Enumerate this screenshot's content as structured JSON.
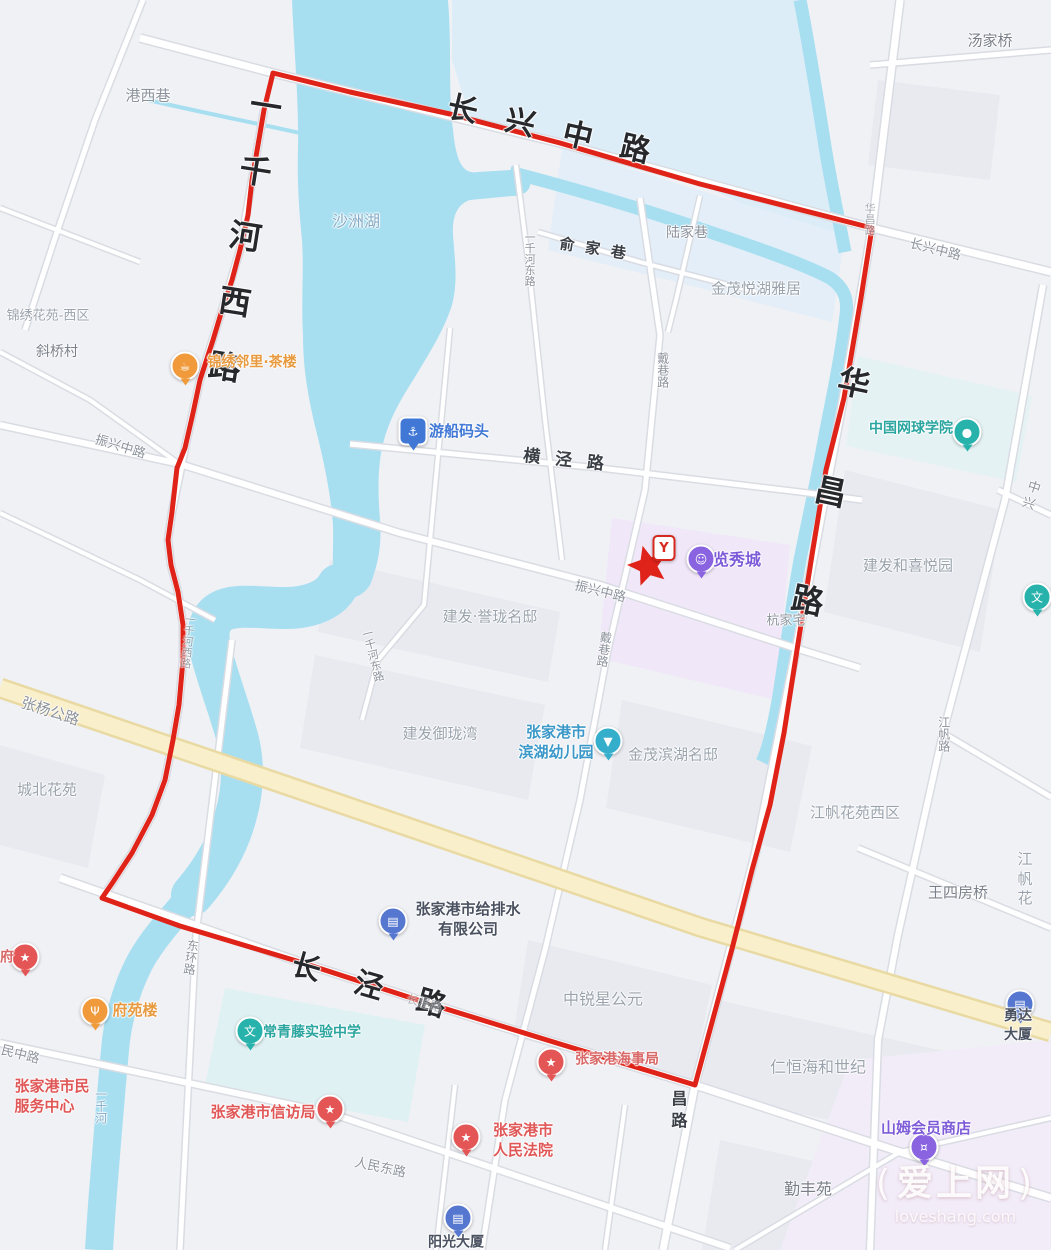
{
  "map": {
    "palette": {
      "road": "#8d939c",
      "town": "#7a8089",
      "area": "#9aa3ad",
      "water": "#85abc6",
      "big": "#26282c",
      "semidark": "#3a3f46",
      "red": "#e05757",
      "maroon": "#d96868",
      "orange": "#e89a40",
      "blue": "#4178d6",
      "purple": "#7d5bd8",
      "teal": "#2ba5a0",
      "kteal": "#3b98c8",
      "slate": "#4a5160"
    },
    "labels": [
      {
        "t": "港西巷",
        "x": 148,
        "y": 96,
        "s": 15,
        "c": "road"
      },
      {
        "t": "汤家桥",
        "x": 990,
        "y": 41,
        "s": 15,
        "c": "town"
      },
      {
        "t": "沙洲湖",
        "x": 356,
        "y": 222,
        "s": 16,
        "c": "water"
      },
      {
        "t": "长兴中路",
        "x": 563,
        "y": 133,
        "s": 30,
        "c": "big",
        "r": 13,
        "ls": 29,
        "w": 700
      },
      {
        "t": "一千河西路",
        "x": 240,
        "y": 252,
        "s": 32,
        "c": "big",
        "v": true,
        "r": 9,
        "ls": 34,
        "w": 700
      },
      {
        "t": "华昌路",
        "x": 820,
        "y": 529,
        "s": 32,
        "c": "big",
        "v": true,
        "r": 12,
        "ls": 79,
        "w": 700
      },
      {
        "t": "长泾路",
        "x": 386,
        "y": 991,
        "s": 29,
        "c": "big",
        "r": 16,
        "ls": 36,
        "w": 700
      },
      {
        "t": "昌路",
        "x": 677,
        "y": 1112,
        "s": 16,
        "c": "semidark",
        "v": true,
        "ls": 6,
        "w": 600
      },
      {
        "t": "长兴中路",
        "x": 935,
        "y": 251,
        "s": 13,
        "c": "road",
        "r": 14
      },
      {
        "t": "华昌路",
        "x": 869,
        "y": 219,
        "s": 11,
        "c": "road",
        "v": true,
        "o": 0.75
      },
      {
        "t": "陆家巷",
        "x": 687,
        "y": 233,
        "s": 14,
        "c": "road"
      },
      {
        "t": "俞家巷",
        "x": 598,
        "y": 250,
        "s": 15,
        "c": "semidark",
        "r": 9,
        "ls": 11,
        "w": 600
      },
      {
        "t": "金茂悦湖雅居",
        "x": 756,
        "y": 289,
        "s": 15,
        "c": "area"
      },
      {
        "t": "一千河东路",
        "x": 529,
        "y": 259,
        "s": 11,
        "c": "road",
        "v": true
      },
      {
        "t": "中兴",
        "x": 1031,
        "y": 497,
        "s": 13,
        "c": "road",
        "r": 18
      },
      {
        "t": "建发和喜悦园",
        "x": 908,
        "y": 566,
        "s": 15,
        "c": "area"
      },
      {
        "t": "戴巷路",
        "x": 662,
        "y": 370,
        "s": 12,
        "c": "road",
        "v": true
      },
      {
        "t": "横泾路",
        "x": 571,
        "y": 461,
        "s": 17,
        "c": "semidark",
        "r": 6,
        "ls": 15,
        "w": 600
      },
      {
        "t": "杭家宅",
        "x": 786,
        "y": 622,
        "s": 13,
        "c": "road"
      },
      {
        "t": "振兴中路",
        "x": 600,
        "y": 593,
        "s": 13,
        "c": "road",
        "r": 14
      },
      {
        "t": "戴巷路",
        "x": 603,
        "y": 649,
        "s": 12,
        "c": "road",
        "v": true,
        "r": 8
      },
      {
        "t": "建发·誉珑名邸",
        "x": 490,
        "y": 617,
        "s": 15,
        "c": "area"
      },
      {
        "t": "一千河东路",
        "x": 372,
        "y": 655,
        "s": 11,
        "c": "road",
        "v": true,
        "r": -14
      },
      {
        "t": "建发御珑湾",
        "x": 440,
        "y": 734,
        "s": 15,
        "c": "area"
      },
      {
        "t": "金茂滨湖名邸",
        "x": 673,
        "y": 755,
        "s": 15,
        "c": "area"
      },
      {
        "t": "振兴中路",
        "x": 120,
        "y": 448,
        "s": 13,
        "c": "road",
        "r": 17
      },
      {
        "t": "张杨公路",
        "x": 50,
        "y": 712,
        "s": 15,
        "c": "road",
        "r": 18
      },
      {
        "t": "锦绣花苑-西区",
        "x": 48,
        "y": 317,
        "s": 13,
        "c": "area"
      },
      {
        "t": "斜桥村",
        "x": 57,
        "y": 352,
        "s": 14,
        "c": "town"
      },
      {
        "t": "城北花苑",
        "x": 47,
        "y": 790,
        "s": 15,
        "c": "area"
      },
      {
        "t": "一千河西路",
        "x": 187,
        "y": 641,
        "s": 11,
        "c": "road",
        "v": true,
        "r": 6,
        "o": 0.8
      },
      {
        "t": "江帆路",
        "x": 943,
        "y": 734,
        "s": 12,
        "c": "road",
        "v": true
      },
      {
        "t": "江帆花苑西区",
        "x": 855,
        "y": 813,
        "s": 15,
        "c": "area"
      },
      {
        "t": "王四房桥",
        "x": 958,
        "y": 893,
        "s": 15,
        "c": "town"
      },
      {
        "t": "江帆花",
        "x": 1025,
        "y": 879,
        "s": 15,
        "c": "area"
      },
      {
        "t": "中锐星公元",
        "x": 603,
        "y": 1000,
        "s": 16,
        "c": "area"
      },
      {
        "t": "仁恒海和世纪",
        "x": 818,
        "y": 1068,
        "s": 16,
        "c": "area"
      },
      {
        "t": "勤丰苑",
        "x": 808,
        "y": 1190,
        "s": 16,
        "c": "town"
      },
      {
        "t": "东环路",
        "x": 190,
        "y": 957,
        "s": 12,
        "c": "road",
        "v": true,
        "r": 8
      },
      {
        "t": "民中路",
        "x": 20,
        "y": 1056,
        "s": 13,
        "c": "road",
        "r": 14
      },
      {
        "t": "人民东路",
        "x": 380,
        "y": 1169,
        "s": 13,
        "c": "road",
        "r": 12
      },
      {
        "t": "长泾路",
        "x": 424,
        "y": 1004,
        "s": 12,
        "c": "road",
        "r": 16,
        "o": 0.6
      },
      {
        "t": "一千河",
        "x": 100,
        "y": 1106,
        "s": 12,
        "c": "water",
        "v": true
      }
    ],
    "pois": [
      {
        "label": "锦绣邻里·茶楼",
        "x": 252,
        "y": 363,
        "s": 14,
        "color": "orange",
        "name": "teahouse-poi-label",
        "icon": {
          "x": 185,
          "y": 366,
          "bg": "#f09a3c",
          "glyph": "☕",
          "name": "teahouse-icon"
        }
      },
      {
        "label": "游船码头",
        "x": 459,
        "y": 431,
        "s": 15,
        "color": "blue",
        "name": "boat-dock-poi-label",
        "icon": {
          "x": 413,
          "y": 431,
          "bg": "#4178d6",
          "glyph": "⚓",
          "shape": "square",
          "name": "anchor-icon"
        }
      },
      {
        "label": "览秀城",
        "x": 737,
        "y": 560,
        "s": 16,
        "color": "purple",
        "name": "mall-poi-label",
        "icon": {
          "x": 701,
          "y": 559,
          "bg": "#8a63e0",
          "glyph": "☺",
          "name": "mall-icon"
        }
      },
      {
        "label": "",
        "x": 0,
        "y": 0,
        "s": 0,
        "color": "red",
        "name": "brand-badge",
        "icon": {
          "x": 664,
          "y": 548,
          "bg": "#ffffff",
          "glyph": "Y",
          "shape": "badge",
          "name": "brand-badge-icon"
        }
      },
      {
        "label": "中国网球学院",
        "x": 911,
        "y": 429,
        "s": 14,
        "color": "teal",
        "name": "tennis-academy-poi-label",
        "icon": {
          "x": 967,
          "y": 432,
          "bg": "#28b2ac",
          "glyph": "●",
          "name": "tennis-icon"
        }
      },
      {
        "label": "",
        "x": 0,
        "y": 0,
        "s": 0,
        "color": "teal",
        "name": "culture-poi",
        "icon": {
          "x": 1037,
          "y": 597,
          "bg": "#28b2ac",
          "glyph": "文",
          "name": "culture-icon"
        }
      },
      {
        "label": "张家港市\n滨湖幼儿园",
        "x": 556,
        "y": 742,
        "s": 15,
        "color": "kteal",
        "name": "kindergarten-poi-label",
        "icon": {
          "x": 608,
          "y": 741,
          "bg": "#35aecb",
          "glyph": "▼",
          "name": "kindergarten-icon"
        }
      },
      {
        "label": "张家港市给排水\n有限公司",
        "x": 468,
        "y": 919,
        "s": 15,
        "color": "slate",
        "name": "water-company-poi-label",
        "icon": {
          "x": 393,
          "y": 921,
          "bg": "#5577d0",
          "glyph": "▤",
          "name": "water-company-icon"
        }
      },
      {
        "label": "张家港海事局",
        "x": 617,
        "y": 1060,
        "s": 14,
        "color": "maroon",
        "name": "maritime-bureau-poi-label",
        "icon": {
          "x": 551,
          "y": 1062,
          "bg": "#e45555",
          "glyph": "★",
          "name": "maritime-star-icon"
        }
      },
      {
        "label": "勇达大厦",
        "x": 1018,
        "y": 1026,
        "s": 14,
        "color": "slate",
        "name": "yongda-tower-poi-label",
        "icon": {
          "x": 1020,
          "y": 1004,
          "bg": "#5577d0",
          "glyph": "▤",
          "name": "office-building-icon"
        }
      },
      {
        "label": "山姆会员商店",
        "x": 926,
        "y": 1128,
        "s": 15,
        "color": "purple",
        "name": "sams-club-poi-label",
        "icon": {
          "x": 924,
          "y": 1147,
          "bg": "#8a63e0",
          "glyph": "¤",
          "name": "shopping-cart-icon"
        }
      },
      {
        "label": "府",
        "x": 7,
        "y": 958,
        "s": 14,
        "color": "maroon",
        "name": "fu-poi-label",
        "icon": {
          "x": 25,
          "y": 957,
          "bg": "#e45555",
          "glyph": "★",
          "name": "star-poi-icon"
        }
      },
      {
        "label": "府苑楼",
        "x": 135,
        "y": 1010,
        "s": 15,
        "color": "orange",
        "name": "restaurant-poi-label",
        "icon": {
          "x": 95,
          "y": 1011,
          "bg": "#f09a3c",
          "glyph": "Ψ",
          "name": "restaurant-icon"
        }
      },
      {
        "label": "常青藤实验中学",
        "x": 312,
        "y": 1033,
        "s": 14,
        "color": "teal",
        "name": "school-poi-label",
        "icon": {
          "x": 250,
          "y": 1031,
          "bg": "#28b2ac",
          "glyph": "文",
          "name": "school-icon"
        }
      },
      {
        "label": "张家港市民\n服务中心",
        "x": 52,
        "y": 1096,
        "s": 15,
        "color": "red",
        "align": "left",
        "name": "civic-center-poi-label"
      },
      {
        "label": "张家港市信访局",
        "x": 263,
        "y": 1112,
        "s": 15,
        "color": "red",
        "name": "petition-bureau-poi-label",
        "icon": {
          "x": 330,
          "y": 1109,
          "bg": "#e45555",
          "glyph": "★",
          "name": "petition-star-icon"
        }
      },
      {
        "label": "张家港市\n人民法院",
        "x": 523,
        "y": 1140,
        "s": 15,
        "color": "red",
        "name": "court-poi-label",
        "icon": {
          "x": 466,
          "y": 1137,
          "bg": "#e45555",
          "glyph": "★",
          "name": "court-star-icon"
        }
      },
      {
        "label": "阳光大厦",
        "x": 456,
        "y": 1243,
        "s": 14,
        "color": "slate",
        "name": "sunshine-tower-poi-label",
        "icon": {
          "x": 458,
          "y": 1218,
          "bg": "#5577d0",
          "glyph": "▤",
          "name": "tower-building-icon"
        }
      }
    ],
    "watermark": {
      "title": "爱上网",
      "domain": "loveshang.com"
    }
  },
  "overlay": {
    "boundary_color": "#e02318",
    "boundary_width": 5,
    "boundary_points": [
      [
        273,
        73
      ],
      [
        350,
        92
      ],
      [
        450,
        114
      ],
      [
        560,
        143
      ],
      [
        700,
        184
      ],
      [
        872,
        228
      ],
      [
        861,
        298
      ],
      [
        844,
        398
      ],
      [
        826,
        470
      ],
      [
        812,
        555
      ],
      [
        797,
        650
      ],
      [
        784,
        733
      ],
      [
        770,
        805
      ],
      [
        752,
        870
      ],
      [
        733,
        945
      ],
      [
        714,
        1015
      ],
      [
        695,
        1085
      ],
      [
        560,
        1044
      ],
      [
        430,
        1004
      ],
      [
        300,
        962
      ],
      [
        180,
        926
      ],
      [
        102,
        898
      ],
      [
        113,
        882
      ],
      [
        132,
        853
      ],
      [
        152,
        815
      ],
      [
        165,
        780
      ],
      [
        173,
        740
      ],
      [
        179,
        705
      ],
      [
        183,
        660
      ],
      [
        183,
        625
      ],
      [
        178,
        592
      ],
      [
        171,
        565
      ],
      [
        168,
        540
      ],
      [
        172,
        512
      ],
      [
        177,
        468
      ],
      [
        185,
        448
      ],
      [
        193,
        413
      ],
      [
        200,
        380
      ],
      [
        213,
        340
      ],
      [
        222,
        310
      ],
      [
        232,
        280
      ],
      [
        240,
        250
      ],
      [
        248,
        215
      ],
      [
        252,
        180
      ],
      [
        258,
        145
      ],
      [
        264,
        110
      ]
    ],
    "star": {
      "x": 648,
      "y": 566,
      "r_outer": 21,
      "r_inner": 9.5,
      "rotate": -15,
      "color": "#e0231a"
    }
  }
}
